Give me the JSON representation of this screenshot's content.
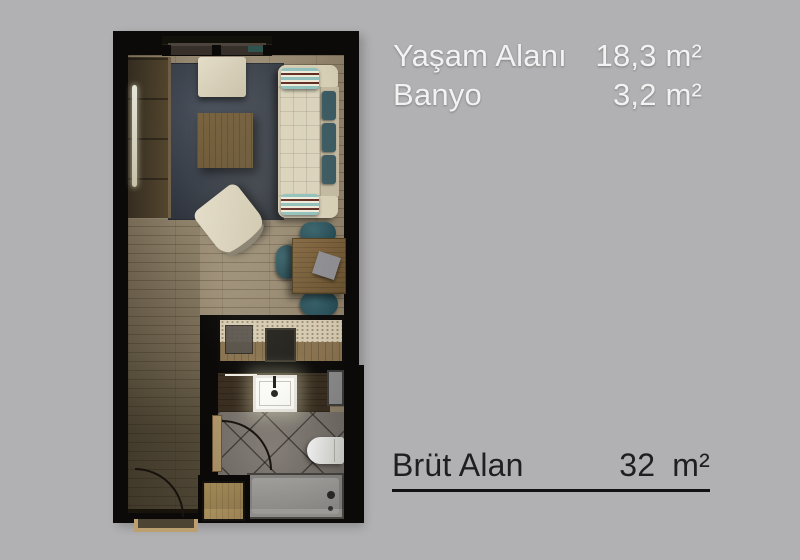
{
  "background_color": "#B1B1B3",
  "legend": {
    "text_color": "#F2F2F2",
    "rows": [
      {
        "label": "Yaşam Alanı",
        "value": "18,3 m²"
      },
      {
        "label": "Banyo",
        "value": "3,2 m²"
      }
    ]
  },
  "total": {
    "label": "Brüt Alan",
    "value": "32",
    "unit": "m²",
    "text_color": "#1F1F21",
    "rule_color": "#121214"
  },
  "floorplan": {
    "wall_color": "#0B0A09",
    "wood_floor_color": "#95876F",
    "entry_floor_color": "#5E5340",
    "rug_color": "#3A414D",
    "sofa_color": "#D3CAB2",
    "cushion_color": "#3C5A61",
    "wood_furniture_color": "#6E5837",
    "tile_color": "#7F7974",
    "counter_color": "#D6CBB2",
    "fixture_color": "#FAFAF7",
    "rooms": [
      "living-area",
      "kitchenette",
      "bathroom",
      "entry-hall"
    ],
    "furniture": [
      "window",
      "wardrobe",
      "mirror-strip",
      "rug",
      "pouf",
      "coffee-table",
      "sofa",
      "throw-pillows",
      "back-cushions",
      "lounge-chair",
      "dining-table",
      "dining-chairs",
      "napkin",
      "kitchen-counter",
      "cooktop",
      "kitchen-appliance",
      "bathroom-vanity",
      "wash-basin",
      "towel-bar",
      "washing-machine",
      "toilet",
      "bathtub",
      "bathroom-door",
      "entry-door",
      "shoe-cabinet"
    ]
  }
}
